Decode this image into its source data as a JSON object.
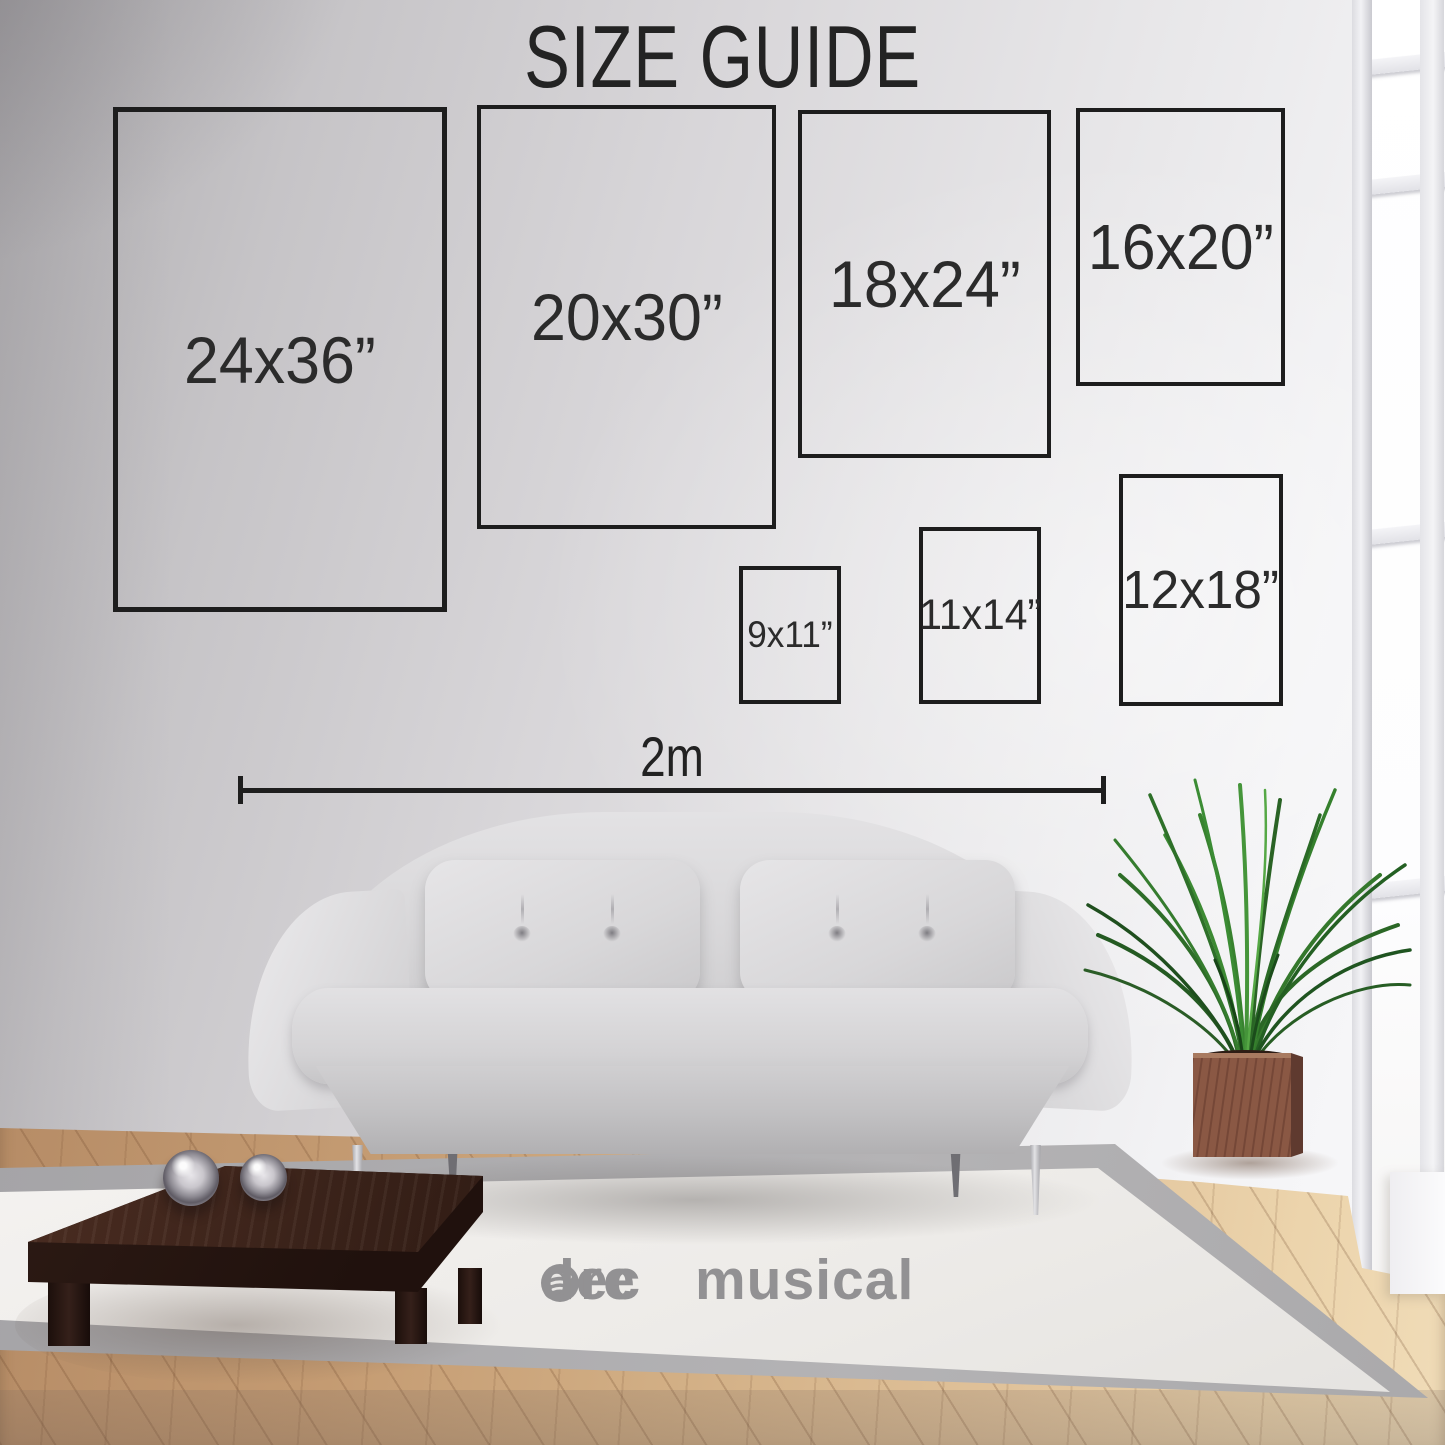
{
  "title": "SIZE GUIDE",
  "size_guide": {
    "boxes": [
      {
        "id": "24x36",
        "label": "24x36”"
      },
      {
        "id": "20x30",
        "label": "20x30”"
      },
      {
        "id": "18x24",
        "label": "18x24”"
      },
      {
        "id": "16x20",
        "label": "16x20”"
      },
      {
        "id": "9x11",
        "label": "9x11”"
      },
      {
        "id": "11x14",
        "label": "11x14”"
      },
      {
        "id": "12x18",
        "label": "12x18”"
      }
    ],
    "scale_bar_label": "2m"
  },
  "logo": {
    "line1": "musical",
    "line2_before_icon": "dec",
    "line2_after_icon": "re",
    "icon": "spotify-icon"
  },
  "colors": {
    "outline": "#1d1d1d",
    "label_text": "#2b2b2b",
    "title_text": "#232323",
    "logo_gray": "#8b8a8c",
    "wall_light": "#f3f3f5",
    "wood_floor": "#d2af85",
    "rug": "#edebe8"
  }
}
